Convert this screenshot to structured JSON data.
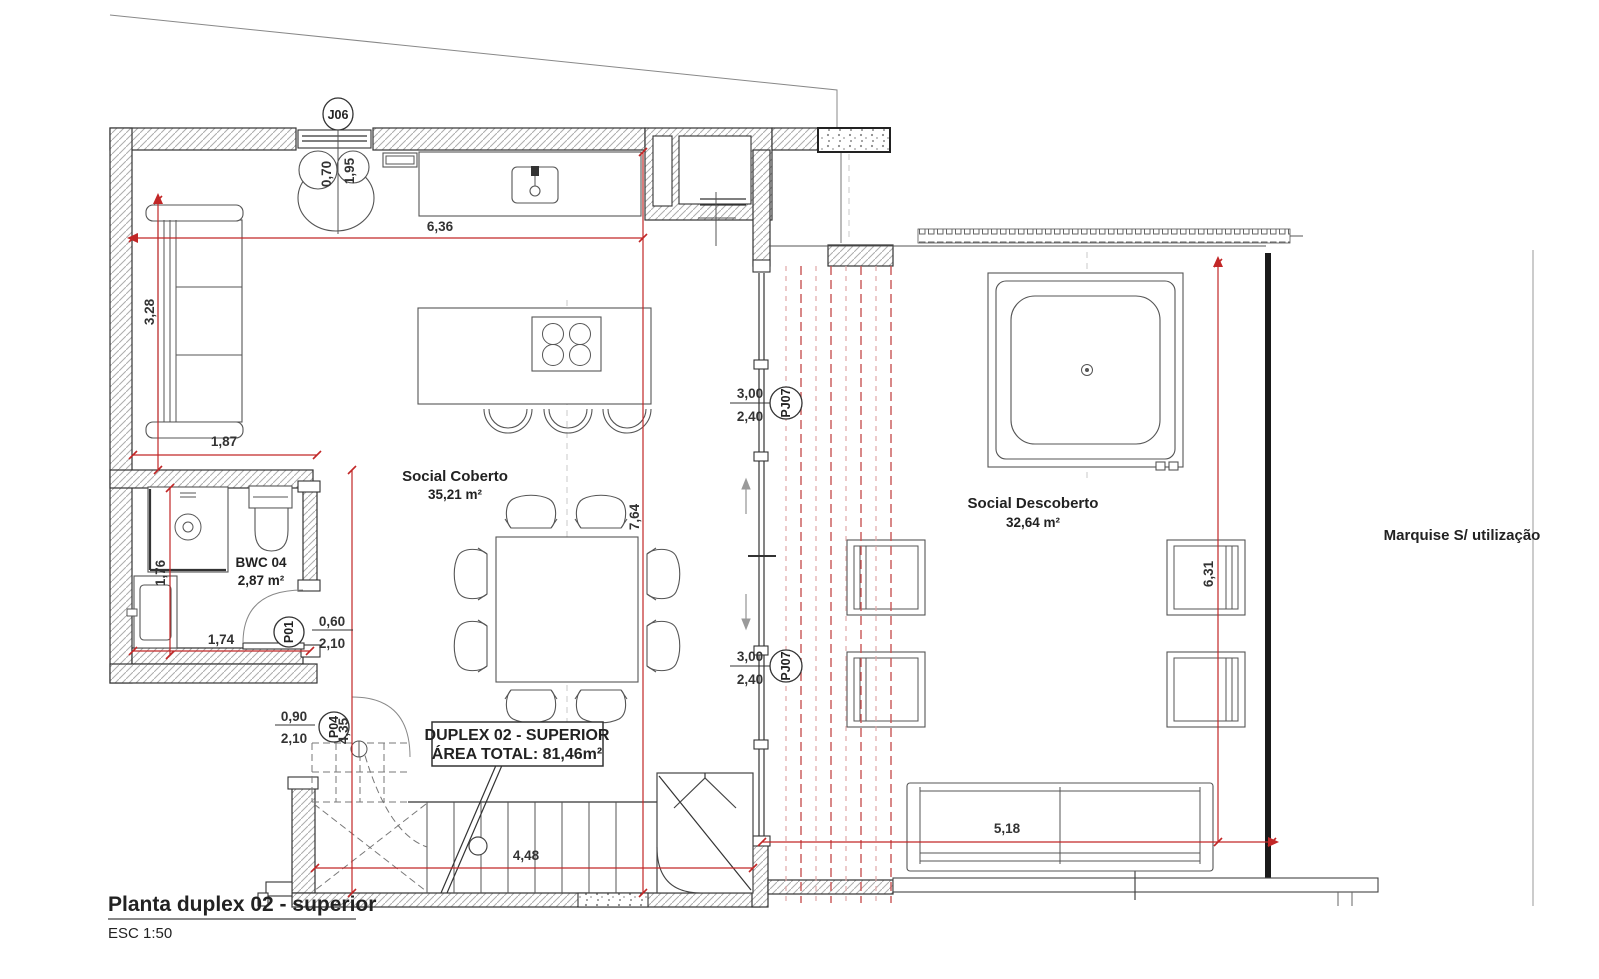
{
  "title": {
    "text": "Planta duplex 02 - superior",
    "scale": "ESC 1:50"
  },
  "info_box": {
    "line1": "DUPLEX 02 - SUPERIOR",
    "line2": "ÁREA TOTAL: 81,46m²"
  },
  "rooms": {
    "social_coberto": {
      "name": "Social Coberto",
      "area": "35,21 m²"
    },
    "social_descoberto": {
      "name": "Social Descoberto",
      "area": "32,64 m²"
    },
    "bwc04": {
      "name": "BWC 04",
      "area": "2,87 m²"
    },
    "marquise": {
      "name": "Marquise S/ utilização"
    }
  },
  "tags": {
    "j06": "J06",
    "p01": "P01",
    "p04": "P04",
    "pj07_top": "PJ07",
    "pj07_bottom": "PJ07"
  },
  "dims": {
    "w_636": "6,36",
    "h_328": "3,28",
    "w_187": "1,87",
    "h_176": "1,76",
    "w_174": "1,74",
    "h_435": "4,35",
    "h_764": "7,64",
    "w_448": "4,48",
    "w_518": "5,18",
    "h_631": "6,31",
    "j06_w": "0,70",
    "j06_h": "1,95",
    "p01_w": "0,60",
    "p01_h": "2,10",
    "p04_w": "0,90",
    "p04_h": "2,10",
    "pj07_top_w": "3,00",
    "pj07_top_h": "2,40",
    "pj07_bottom_w": "3,00",
    "pj07_bottom_h": "2,40"
  }
}
